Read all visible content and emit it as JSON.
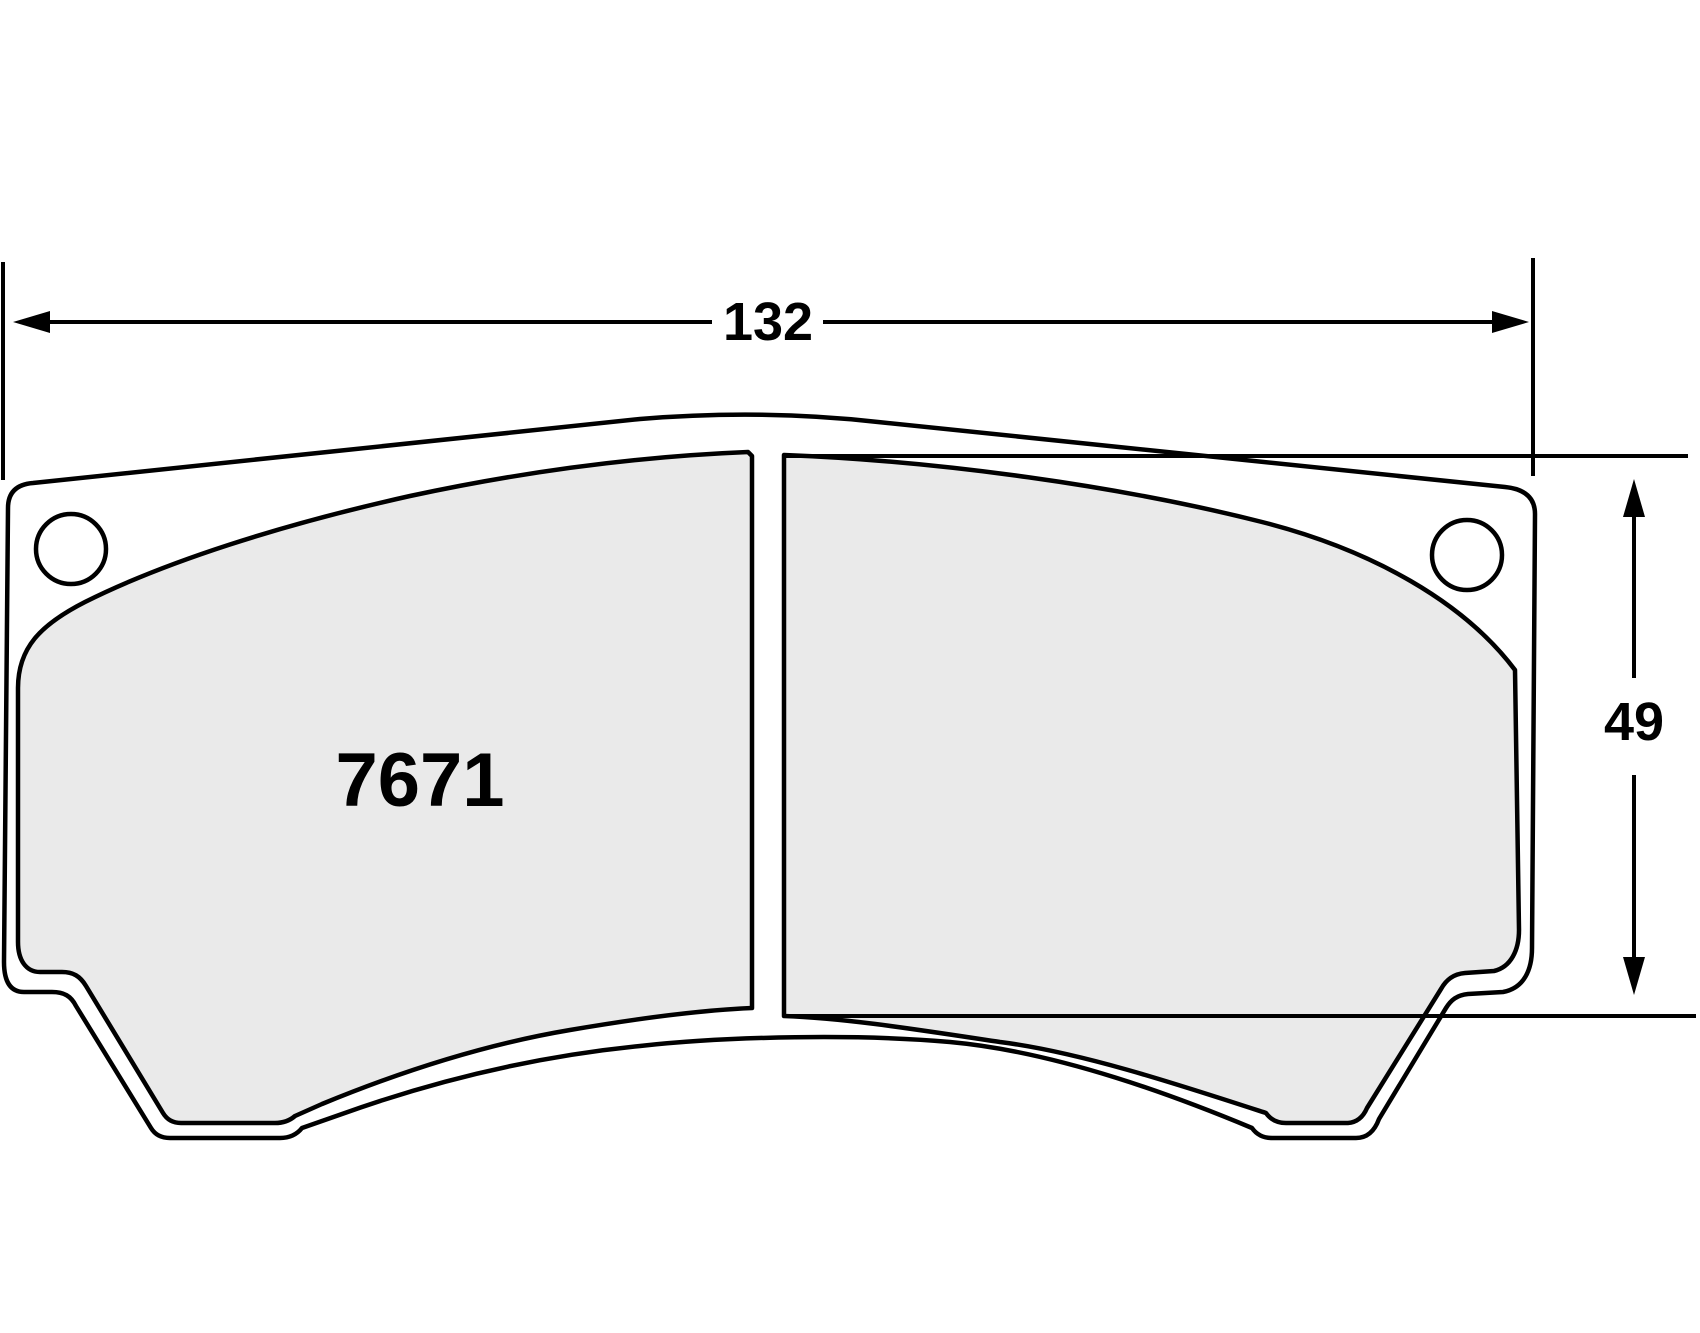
{
  "drawing": {
    "title": "brake-pad-dimension-drawing",
    "part_number": "7671",
    "width_dimension_label": "132",
    "height_dimension_label": "49"
  },
  "colors": {
    "background": "#ffffff",
    "line": "#000000",
    "backplate_fill": "#ffffff",
    "friction_fill": "#eaeaea"
  }
}
